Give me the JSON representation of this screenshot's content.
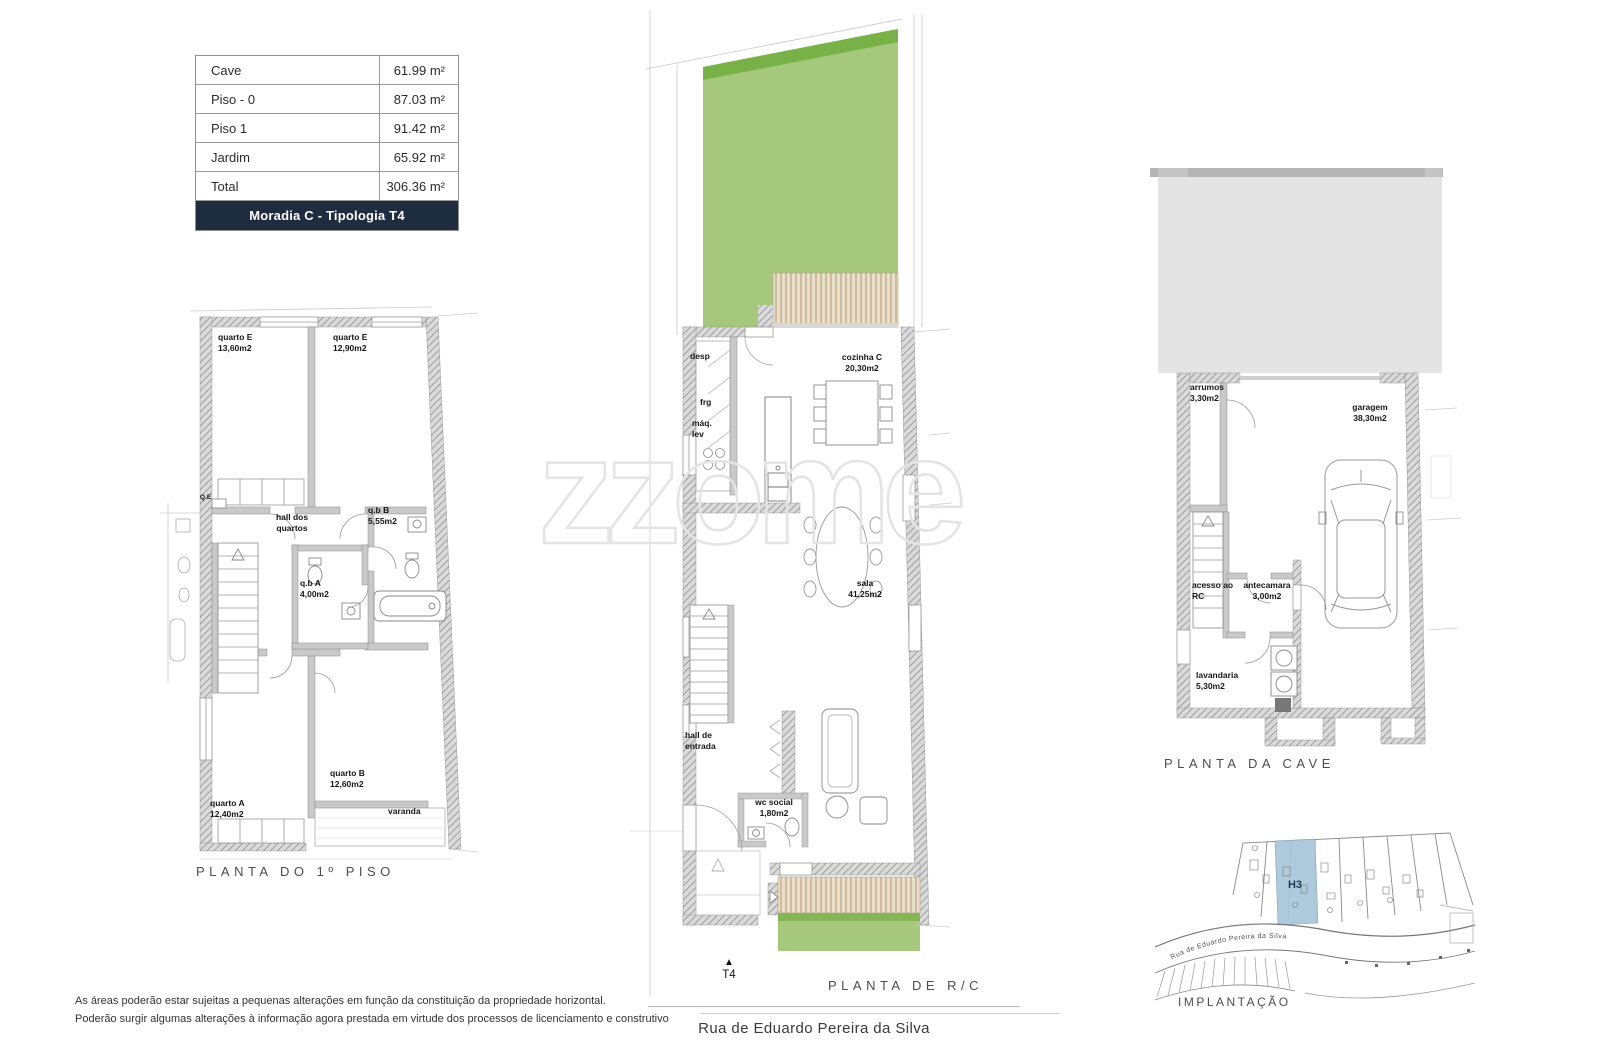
{
  "area_table": {
    "rows": [
      {
        "label": "Cave",
        "value": "61.99 m²"
      },
      {
        "label": "Piso - 0",
        "value": "87.03 m²"
      },
      {
        "label": "Piso 1",
        "value": "91.42 m²"
      },
      {
        "label": "Jardim",
        "value": "65.92 m²"
      },
      {
        "label": "Total",
        "value": "306.36 m²"
      }
    ],
    "footer": "Moradia C - Tipologia T4"
  },
  "watermark_text": "zzome",
  "first_floor": {
    "title": "PLANTA DO 1º PISO",
    "rooms": {
      "quarto_e_left": {
        "name": "quarto E",
        "area": "13,60m2"
      },
      "quarto_e_right": {
        "name": "quarto E",
        "area": "12,90m2"
      },
      "electrical_box": "Q.E",
      "hall": "hall dos quartos",
      "bath_b": {
        "name": "q.b B",
        "area": "5,55m2"
      },
      "bath_a": {
        "name": "q.b A",
        "area": "4,00m2"
      },
      "quarto_b": {
        "name": "quarto B",
        "area": "12,60m2"
      },
      "quarto_a": {
        "name": "quarto A",
        "area": "12,40m2"
      },
      "varanda": "varanda"
    }
  },
  "ground_floor": {
    "title": "PLANTA DE R/C",
    "unit_marker": "T4",
    "street": "Rua de Eduardo Pereira da Silva",
    "rooms": {
      "desp": "desp",
      "frg": "frg",
      "maq_lev": "máq. lev",
      "cozinha": {
        "name": "cozinha C",
        "area": "20,30m2"
      },
      "sala": {
        "name": "sala",
        "area": "41,25m2"
      },
      "hall": "hall de entrada",
      "wc": {
        "name": "wc social",
        "area": "1,80m2"
      }
    }
  },
  "cave": {
    "title": "PLANTA DA CAVE",
    "rooms": {
      "arrumos": {
        "name": "arrumos",
        "area": "3,30m2"
      },
      "garagem": {
        "name": "garagem",
        "area": "38,30m2"
      },
      "acesso": "acesso ao RC",
      "antecamara": {
        "name": "antecamara",
        "area": "3,00m2"
      },
      "lavandaria": {
        "name": "lavandaria",
        "area": "5,30m2"
      }
    }
  },
  "implantation": {
    "title": "IMPLANTAÇÃO",
    "unit": "H3",
    "street": "Rua de Eduardo Pereira da Silva"
  },
  "disclaimer": {
    "line1": "As áreas poderão estar sujeitas a pequenas alterações em função da constituição da propriedade horizontal.",
    "line2": "Poderão surgir algumas alterações à informação agora prestada em virtude dos processos de licenciamento e construtivo"
  },
  "colors": {
    "header_navy": "#1e2c40",
    "garden_green": "#a6c87d",
    "garden_green_dark": "#78b148",
    "deck_beige": "#eadfcb",
    "deck_stripe": "#c2ae8e",
    "slab_gray": "#e4e4e4",
    "highlight_blue": "#a9c6da"
  }
}
